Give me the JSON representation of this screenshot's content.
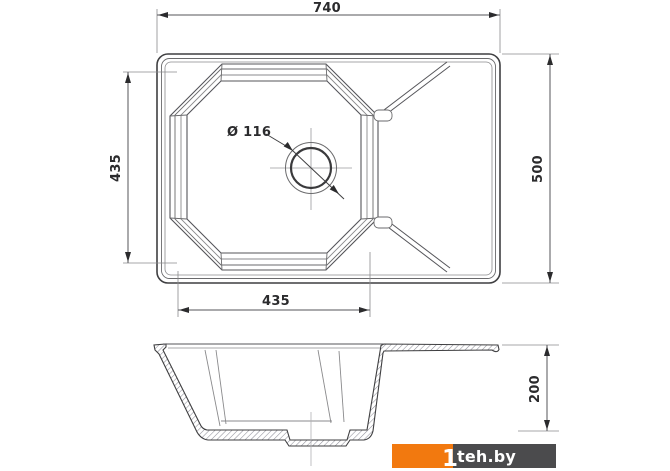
{
  "title": "Kitchen sink technical drawing",
  "views": {
    "top_view": "plan view of sink with bowl and drainboard",
    "section_view": "cross-section of bowl"
  },
  "dimensions": {
    "overall_width": "740",
    "overall_depth": "500",
    "bowl_depth_vertical": "435",
    "bowl_width_horizontal": "435",
    "drain_diameter": "Ø 116",
    "bowl_height": "200"
  },
  "watermark": {
    "prefix": "1",
    "text": "teh.by",
    "orange": "#f2790f",
    "gray": "#4b4b4d"
  },
  "colors": {
    "background": "#ffffff",
    "outline": "#3f3f41",
    "medium_line": "#6a6a6c",
    "light_line": "#8a8a8c",
    "crosshair": "#9a9a9c",
    "dim_line": "#55555a",
    "text": "#2b2b2d"
  }
}
